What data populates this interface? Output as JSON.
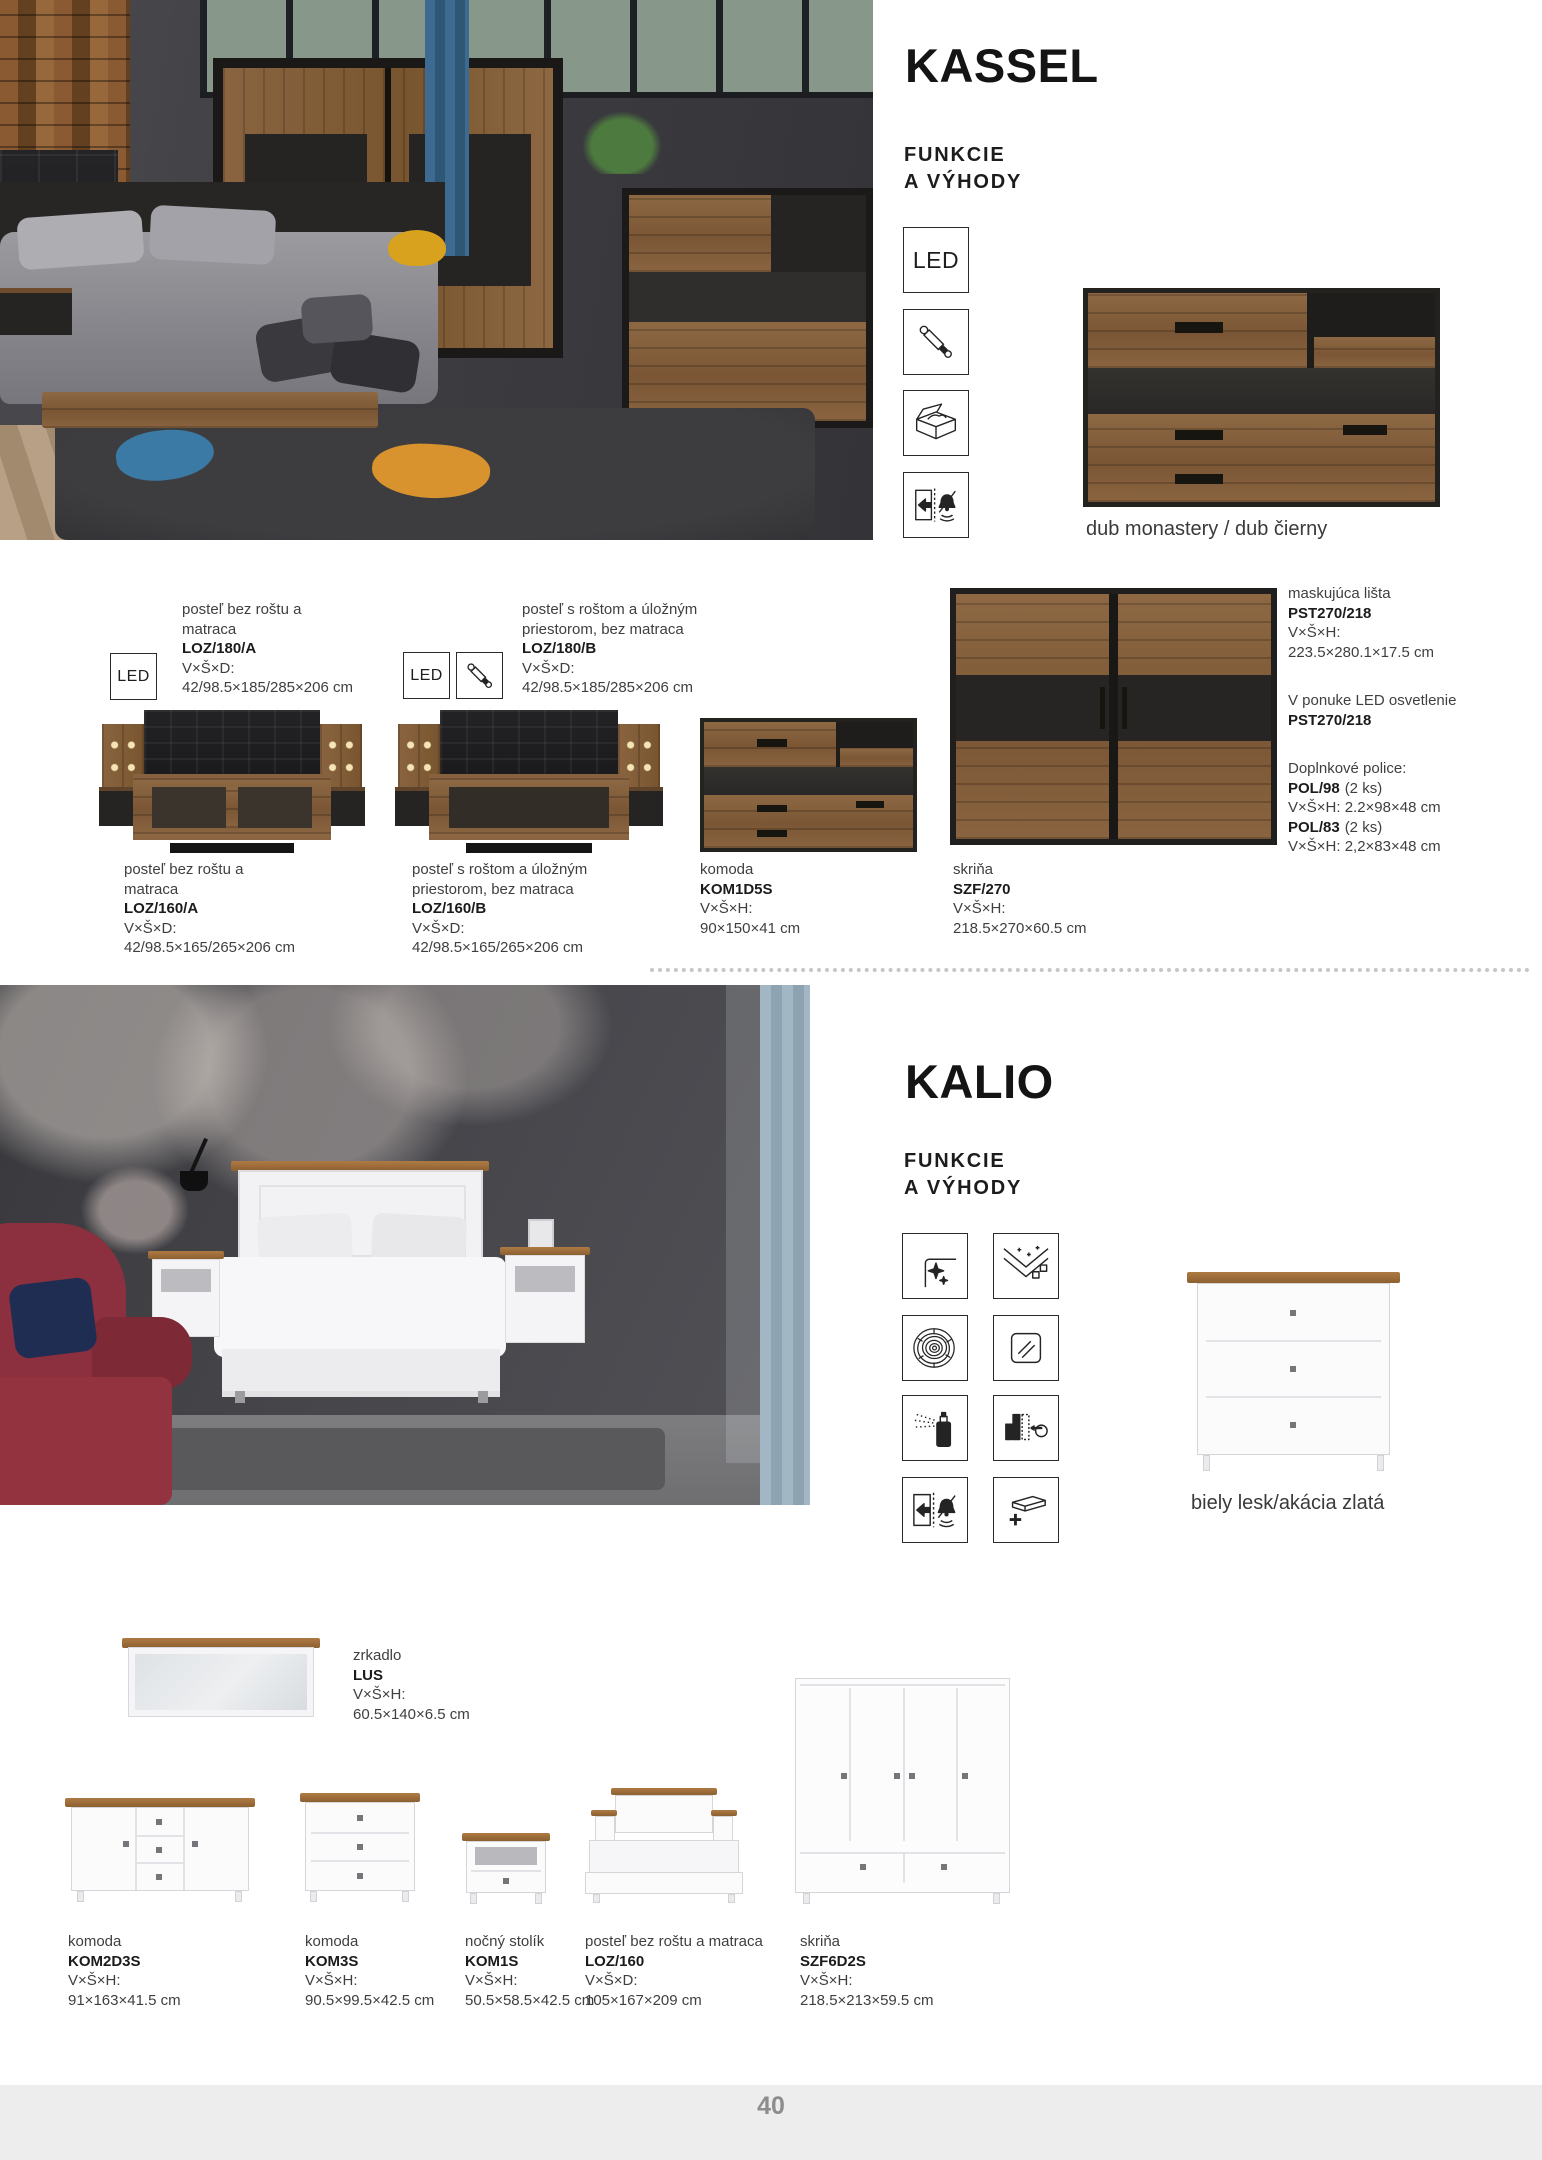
{
  "footer": {
    "page_number": "40"
  },
  "colors": {
    "wood_accent": "#8a6440",
    "dark_panel": "#262422",
    "kalio_wood_top": "#9a6b3a",
    "footer_bg": "#ededed"
  },
  "kassel": {
    "title": "KASSEL",
    "features_heading_line1": "FUNKCIE",
    "features_heading_line2": "A VÝHODY",
    "led_badge": "LED",
    "feature_icons": [
      "led",
      "gas-lift",
      "storage-box",
      "soft-close-silent"
    ],
    "swatch_caption": "dub monastery / dub čierny",
    "beds": [
      {
        "name": "posteľ bez roštu a matraca",
        "code": "LOZ/180/A",
        "dims_label": "V×Š×D:",
        "dims": "42/98.5×185/285×206 cm",
        "icons": [
          "led"
        ]
      },
      {
        "name": "posteľ s roštom a úložným priestorom, bez matraca",
        "code": "LOZ/180/B",
        "dims_label": "V×Š×D:",
        "dims": "42/98.5×185/285×206 cm",
        "icons": [
          "led",
          "gas-lift"
        ]
      },
      {
        "name": "posteľ bez roštu a matraca",
        "code": "LOZ/160/A",
        "dims_label": "V×Š×D:",
        "dims": "42/98.5×165/265×206 cm"
      },
      {
        "name": "posteľ s roštom a úložným priestorom, bez matraca",
        "code": "LOZ/160/B",
        "dims_label": "V×Š×D:",
        "dims": "42/98.5×165/265×206 cm"
      }
    ],
    "komoda": {
      "name": "komoda",
      "code": "KOM1D5S",
      "dims_label": "V×Š×H:",
      "dims": "90×150×41 cm"
    },
    "skrina": {
      "name": "skriňa",
      "code": "SZF/270",
      "dims_label": "V×Š×H:",
      "dims": "218.5×270×60.5 cm"
    },
    "masking_strip": {
      "name": "maskujúca lišta",
      "code": "PST270/218",
      "dims_label": "V×Š×H:",
      "dims": "223.5×280.1×17.5 cm"
    },
    "led_offer": {
      "name": "V ponuke LED osvetlenie",
      "code": "PST270/218"
    },
    "shelves": {
      "heading": "Doplnkové police:",
      "items": [
        {
          "code": "POL/98",
          "qty": "(2 ks)",
          "dims": "V×Š×H: 2.2×98×48 cm"
        },
        {
          "code": "POL/83",
          "qty": "(2 ks)",
          "dims": "V×Š×H: 2,2×83×48 cm"
        }
      ]
    }
  },
  "kalio": {
    "title": "KALIO",
    "features_heading_line1": "FUNKCIE",
    "features_heading_line2": "A VÝHODY",
    "feature_icons": [
      "gloss-surface",
      "decor-surface",
      "wood-grain",
      "glass",
      "spray-lacquer",
      "modular-choice",
      "soft-close-silent",
      "extra-shelf"
    ],
    "swatch_caption": "biely lesk/akácia zlatá",
    "products": [
      {
        "name": "zrkadlo",
        "code": "LUS",
        "dims_label": "V×Š×H:",
        "dims": "60.5×140×6.5 cm"
      },
      {
        "name": "komoda",
        "code": "KOM2D3S",
        "dims_label": "V×Š×H:",
        "dims": "91×163×41.5 cm"
      },
      {
        "name": "komoda",
        "code": "KOM3S",
        "dims_label": "V×Š×H:",
        "dims": "90.5×99.5×42.5 cm"
      },
      {
        "name": "nočný stolík",
        "code": "KOM1S",
        "dims_label": "V×Š×H:",
        "dims": "50.5×58.5×42.5 cm"
      },
      {
        "name": "posteľ bez roštu a matraca",
        "code": "LOZ/160",
        "dims_label": "V×Š×D:",
        "dims": "105×167×209 cm"
      },
      {
        "name": "skriňa",
        "code": "SZF6D2S",
        "dims_label": "V×Š×H:",
        "dims": "218.5×213×59.5 cm"
      }
    ]
  }
}
